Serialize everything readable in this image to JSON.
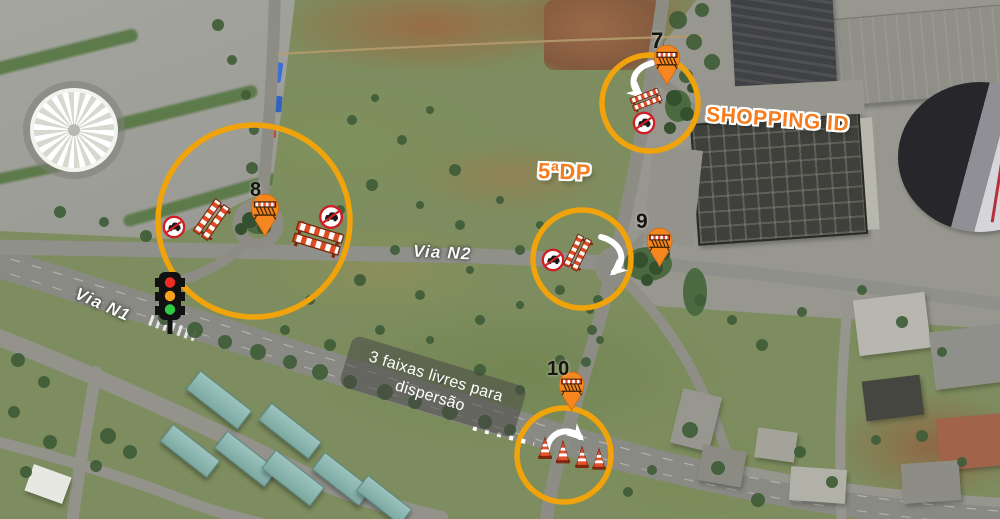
{
  "map": {
    "type": "satellite-operational-map",
    "place_labels": {
      "shopping": "SHOPPING ID",
      "police_station": "5ªDP"
    },
    "road_labels": {
      "via_n2": "Via N2",
      "via_n1": "Via N1"
    },
    "note": {
      "line1": "3 faixas livres para",
      "line2": "dispersão"
    },
    "markers": [
      {
        "number": "7"
      },
      {
        "number": "8"
      },
      {
        "number": "9"
      },
      {
        "number": "10"
      }
    ],
    "colors": {
      "highlight_circle": "#F0A30A",
      "pin_orange": "#F6861F",
      "label_orange": "#F57D1F",
      "no_entry_red": "#CD1F24",
      "cone_red_orange": "#E8502A",
      "arrow_white": "#FFFFFF"
    },
    "icons": {
      "marker_pin": "barrier-pin-icon",
      "prohibition_sign": "no-entry-car-icon",
      "road_block": "barrier-icon",
      "cones": "traffic-cone-icon",
      "signal": "traffic-light-icon",
      "flow": "curved-arrow-icon",
      "guide": "dotted-line"
    }
  }
}
